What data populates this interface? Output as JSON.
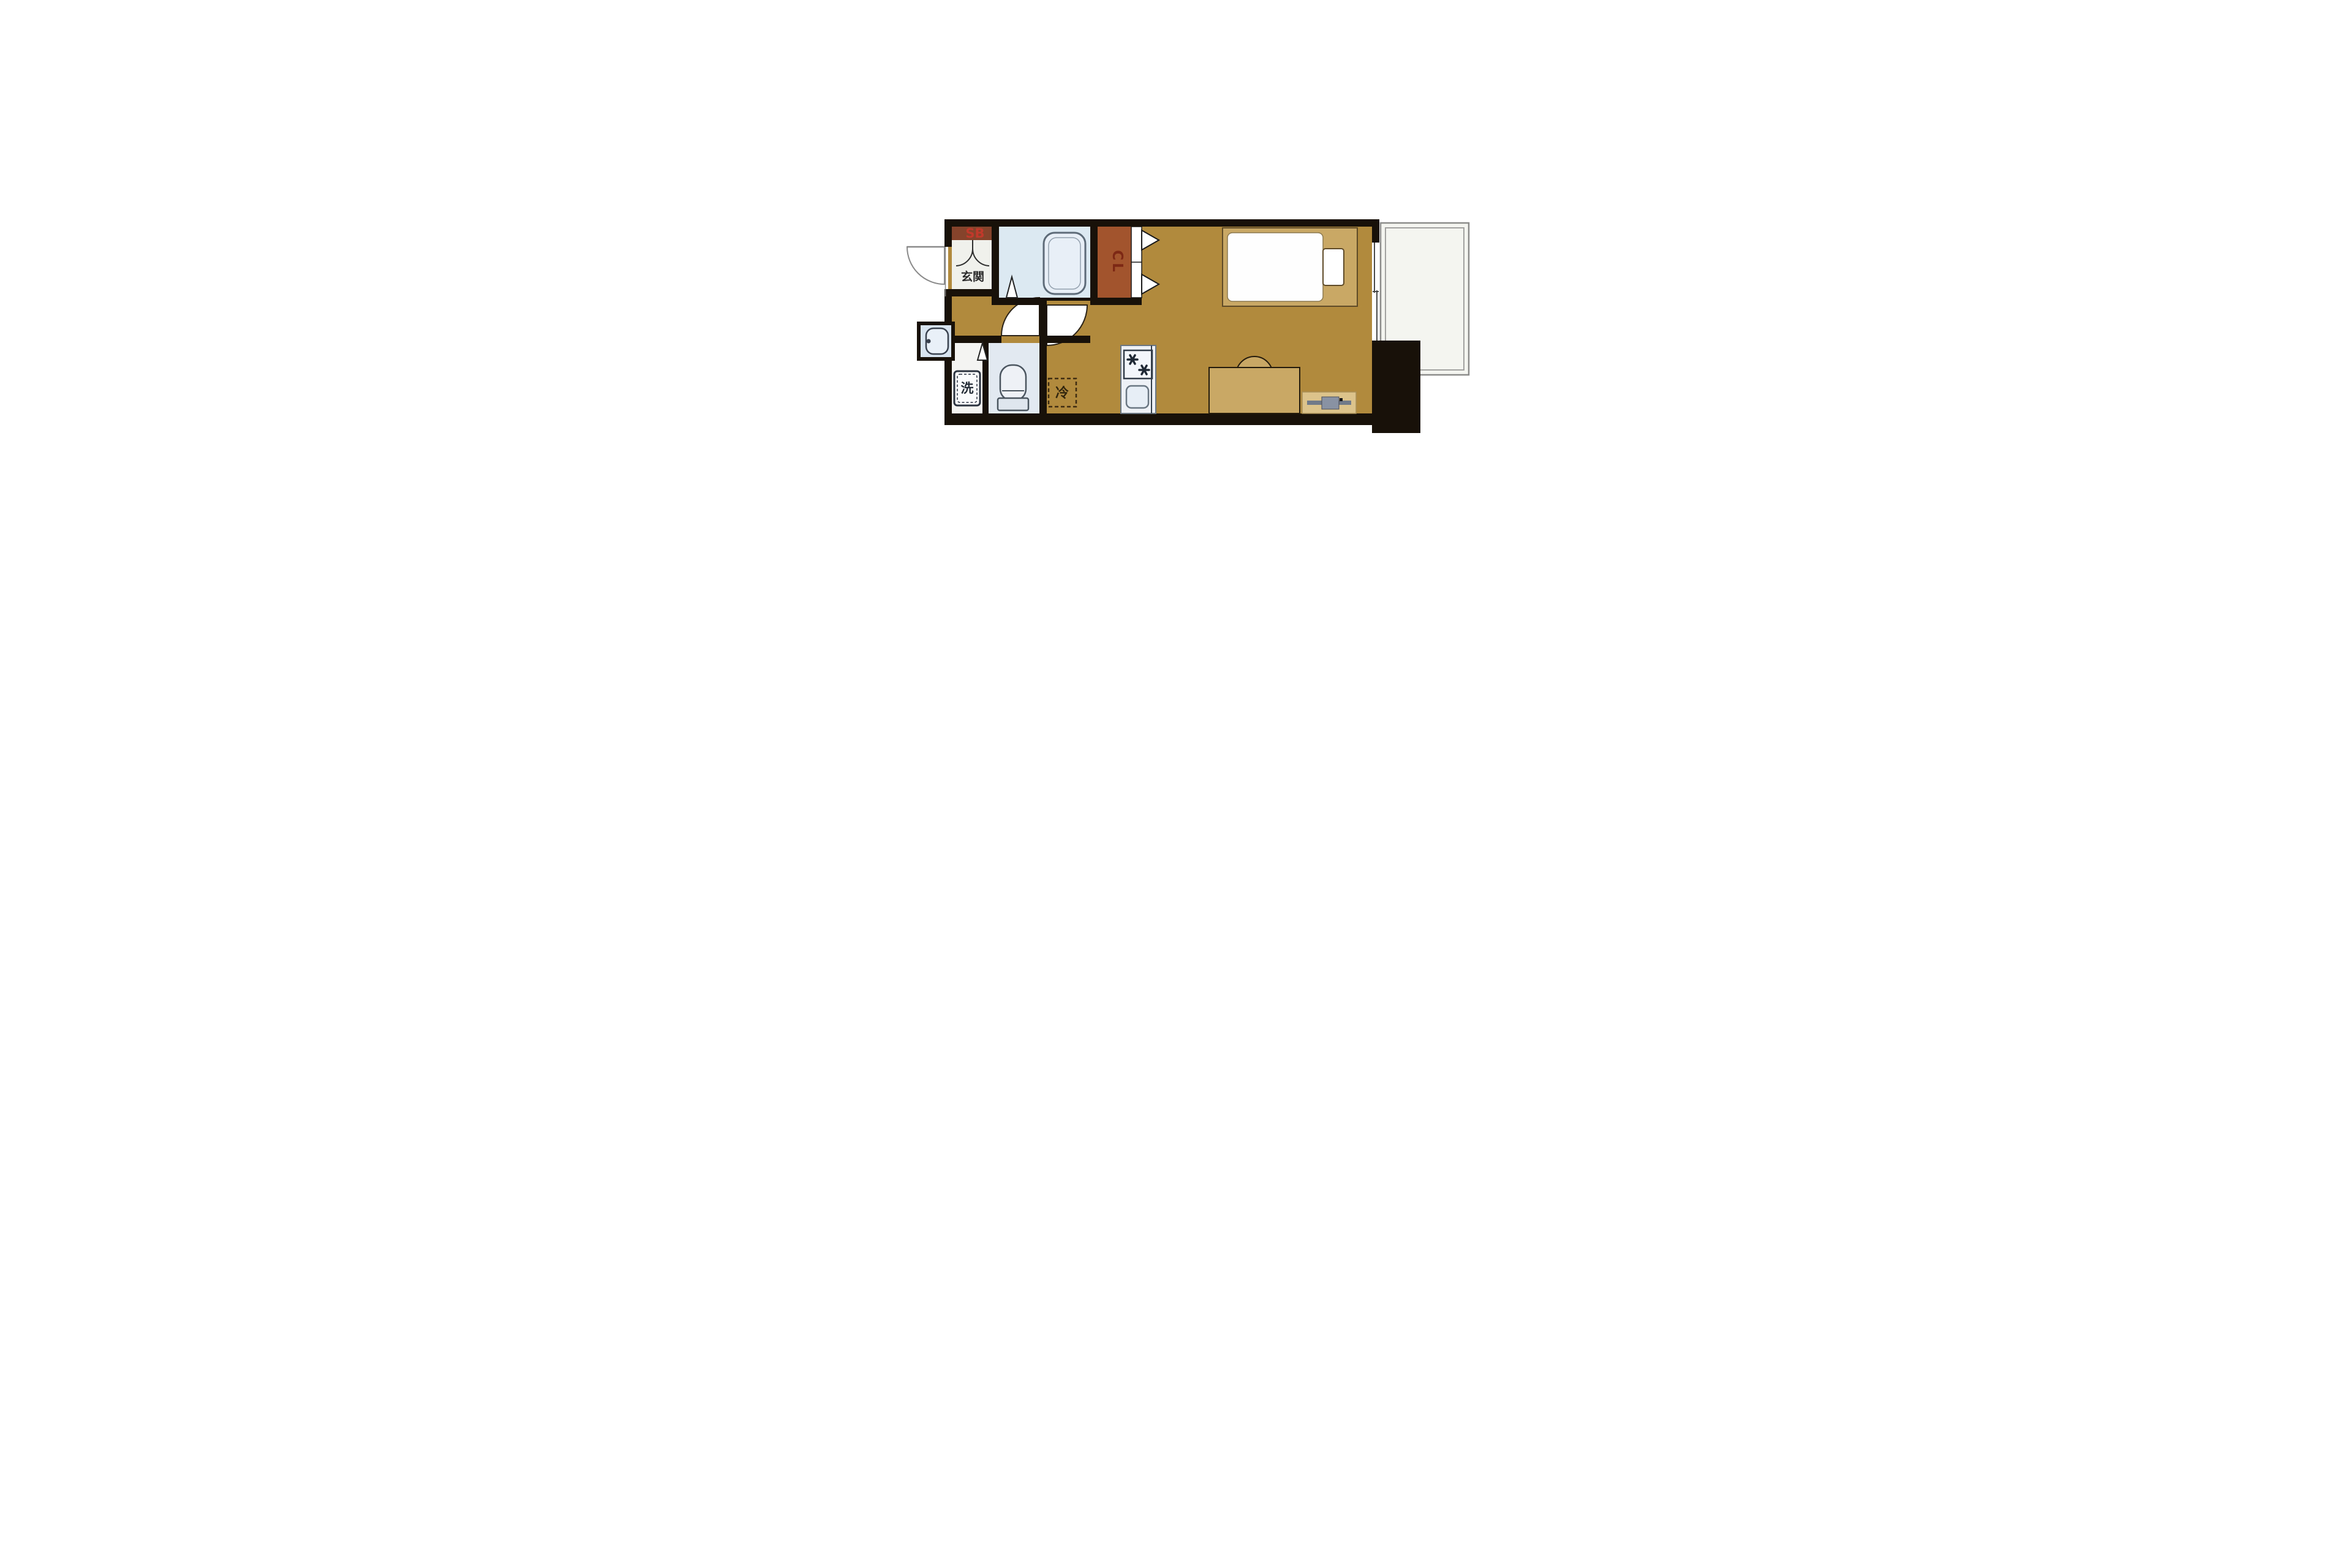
{
  "floorplan": {
    "labels": {
      "shoe_box": "SB",
      "entrance": "玄関",
      "closet": "CL",
      "washing_machine": "洗",
      "refrigerator": "冷"
    },
    "colors": {
      "wall": "#181109",
      "floor": "#b28a3e",
      "bed_frame": "#c9a765",
      "tv_board": "#dcc38c",
      "closet_fill": "#a2542c",
      "shoe_box_fill": "#84432a",
      "shoe_box_text": "#c0392b",
      "closet_text": "#7c2815",
      "bathroom_fill": "#dce8f2",
      "toilet_room_fill": "#e2e9f1",
      "kitchen_fill": "#eef2f7",
      "entrance_fill": "#f0f0ed",
      "laundry_fill": "#f4f4f2",
      "balcony_fill": "#f4f4f1",
      "balcony_border": "#8c8c8a",
      "fixture_stroke": "#4a5560",
      "tv_gray": "#717a88"
    }
  }
}
